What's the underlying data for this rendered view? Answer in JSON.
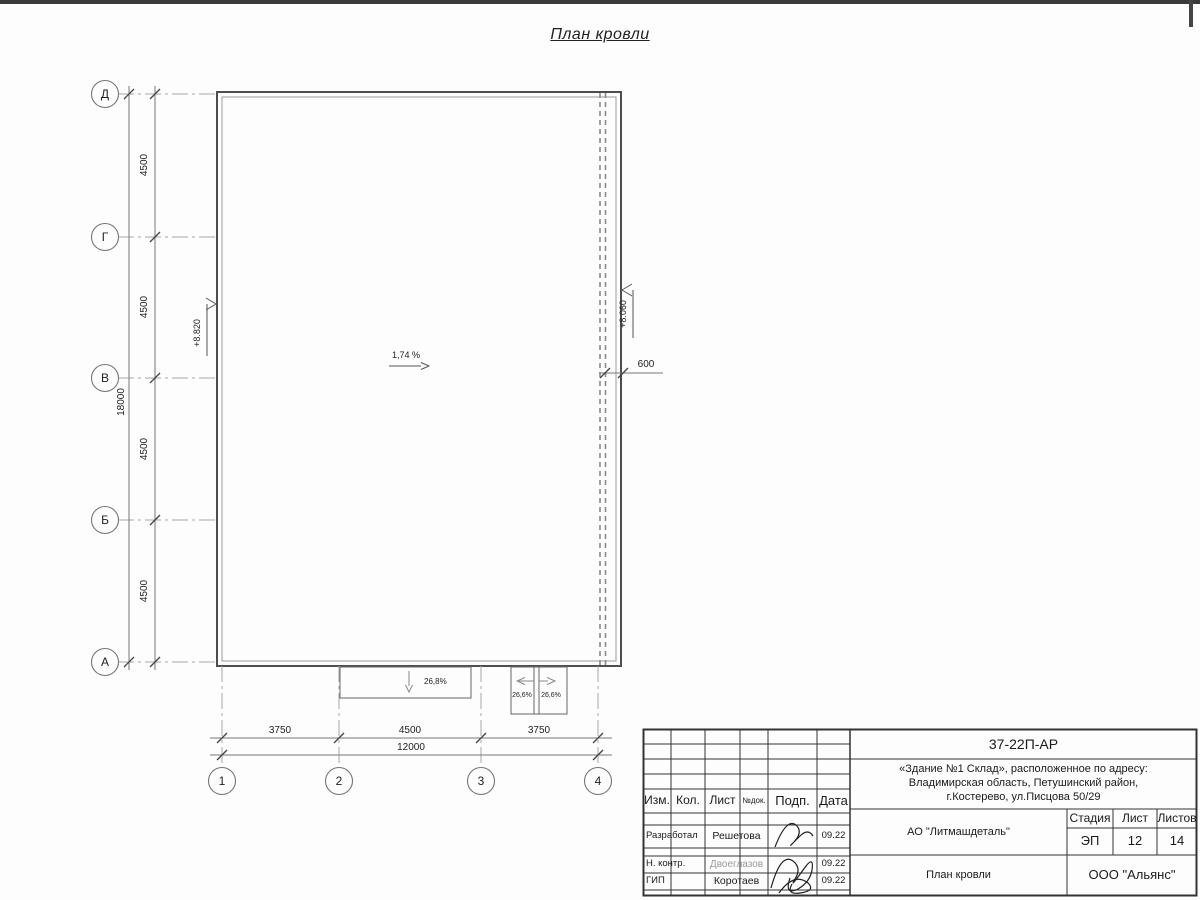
{
  "page": {
    "title": "План кровли"
  },
  "axes": {
    "rows": [
      "Д",
      "Г",
      "В",
      "Б",
      "А"
    ],
    "cols": [
      "1",
      "2",
      "3",
      "4"
    ]
  },
  "dims": {
    "v_seg": [
      "4500",
      "4500",
      "4500",
      "4500"
    ],
    "v_total": "18000",
    "h_seg": [
      "3750",
      "4500",
      "3750"
    ],
    "h_total": "12000",
    "offset_600": "600"
  },
  "ann": {
    "elev_left": "+8.820",
    "elev_right": "+8.060",
    "slope_main": "1,74 %",
    "slope_canopy": "26,8%",
    "slope_c_left": "26,6%",
    "slope_c_right": "26,6%"
  },
  "tb": {
    "code": "37-22П-АР",
    "addr1": "«Здание №1 Склад», расположенное по адресу:",
    "addr2": "Владимирская область, Петушинский район,",
    "addr3": "г.Костерево, ул.Писцова 50/29",
    "col_izm": "Изм.",
    "col_kol": "Кол.",
    "col_list": "Лист",
    "col_doc": "№док.",
    "col_podp": "Подп.",
    "col_data": "Дата",
    "rows": [
      {
        "role": "Разработал",
        "name": "Решетова",
        "date": "09.22"
      },
      {
        "role": "Н. контр.",
        "name": "Двоеглазов",
        "date": "09.22"
      },
      {
        "role": "ГИП",
        "name": "Коротаев",
        "date": "09.22"
      }
    ],
    "org": "АО \"Литмашдеталь\"",
    "stage_label": "Стадия",
    "list_label": "Лист",
    "listov_label": "Листов",
    "stage": "ЭП",
    "list_no": "12",
    "listov": "14",
    "sheet_name": "План кровли",
    "company": "ООО \"Альянс\""
  }
}
